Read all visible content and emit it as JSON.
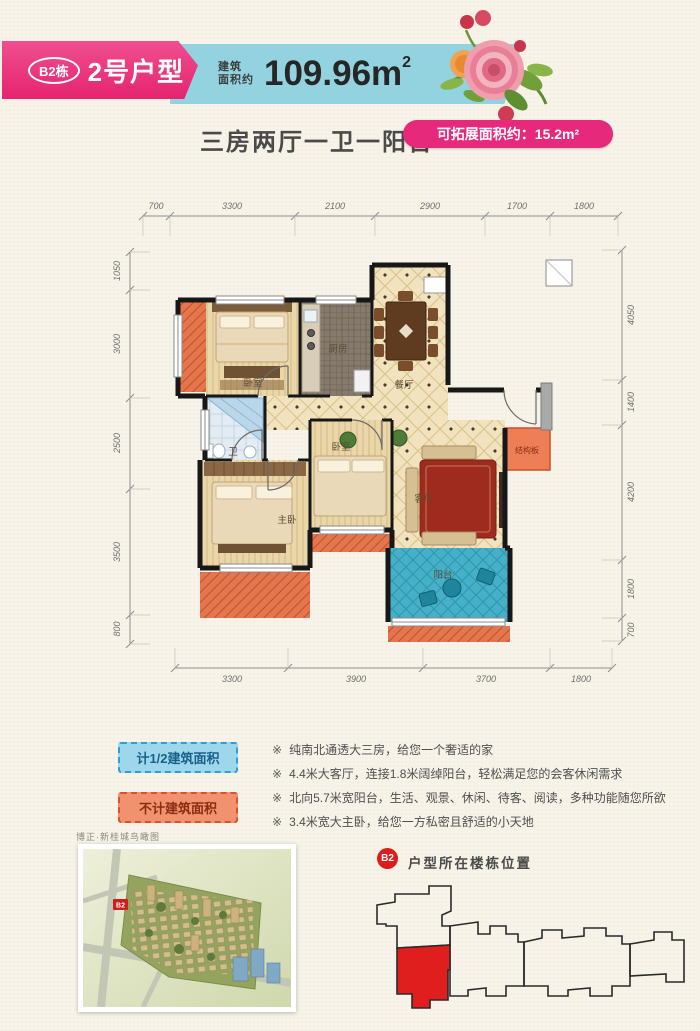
{
  "colors": {
    "accent_pink": "#e6297b",
    "banner_teal": "#93d3df",
    "highlight_red": "#dd1c1c",
    "legend_blue_fill": "#9ed6ec",
    "legend_blue_border": "#2e9fd4",
    "legend_orange_fill": "#f0926d",
    "legend_orange_border": "#e24e2d",
    "balcony_blue": "#46b0c9",
    "hatch_orange": "#e4764e"
  },
  "header": {
    "building_badge": "B2栋",
    "unit_name": "2号户型",
    "area_label_line1": "建筑",
    "area_label_line2": "面积约",
    "area_value": "109.96m",
    "area_superscript": "2",
    "layout_summary": "三房两厅一卫一阳台",
    "expandable_area_badge": "可拓展面积约：15.2m²"
  },
  "floorplan": {
    "dims_top": [
      "700",
      "3300",
      "2100",
      "2900",
      "1700",
      "1800"
    ],
    "dims_left": [
      "1050",
      "3000",
      "2500",
      "3500",
      "800"
    ],
    "dims_right": [
      "4050",
      "1400",
      "4200",
      "1800",
      "700"
    ],
    "dims_bottom": [
      "3300",
      "3900",
      "3700",
      "1800"
    ],
    "rooms": {
      "bedroom_north": "卧室",
      "kitchen": "厨房",
      "dining": "餐厅",
      "bath": "卫",
      "master_bedroom": "主卧",
      "bedroom_mid": "卧室",
      "living": "客厅",
      "balcony": "阳台",
      "structural_slab": "结构板"
    }
  },
  "legend": {
    "half_area_label": "计1/2建筑面积",
    "excluded_area_label": "不计建筑面积"
  },
  "features": {
    "marker": "※",
    "items": [
      "纯南北通透大三房，给您一个奢适的家",
      "4.4米大客厅，连接1.8米阔绰阳台，轻松满足您的会客休闲需求",
      "北向5.7米宽阳台，生活、观景、休闲、待客、阅读，多种功能随您所欲",
      "3.4米宽大主卧，给您一方私密且舒适的小天地"
    ]
  },
  "footer": {
    "aerial_caption": "博正·新桂城鸟瞰图",
    "aerial_marker": "B2",
    "location_badge": "B2",
    "location_title": "户型所在楼栋位置"
  }
}
